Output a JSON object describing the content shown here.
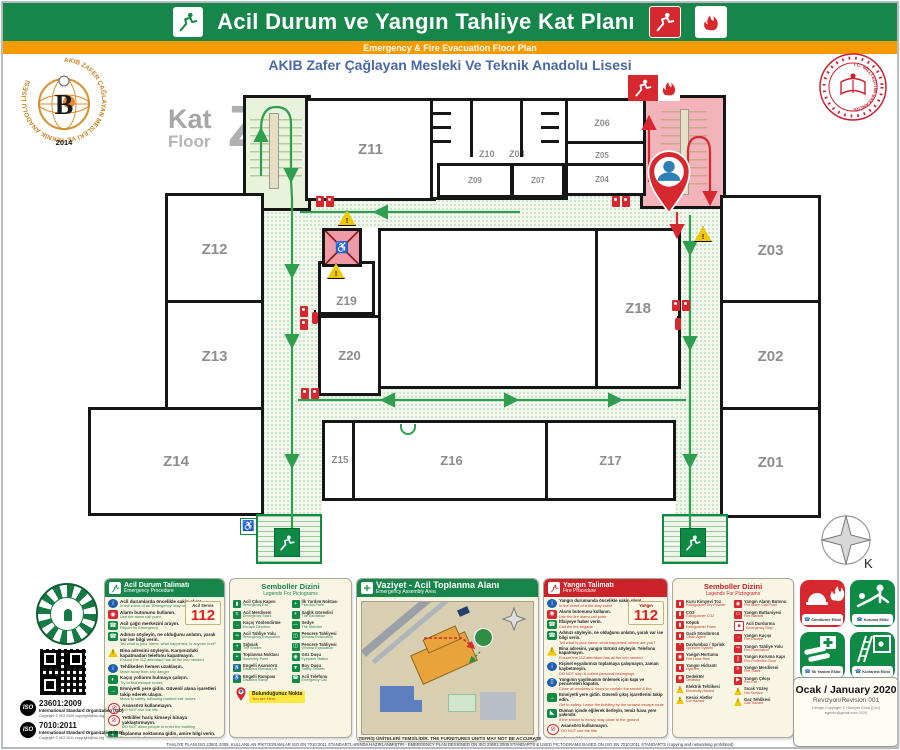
{
  "header": {
    "title": "Acil Durum ve Yangın Tahliye Kat Planı",
    "subtitle": "Emergency & Fire Evacuation Floor Plan",
    "school": "AKIB Zafer Çağlayan Mesleki Ve Teknik Anadolu Lisesi"
  },
  "floor": {
    "kat": "Kat",
    "floor": "Floor",
    "letter": "Z"
  },
  "compass_label": "K",
  "rooms": {
    "z01": "Z01",
    "z02": "Z02",
    "z03": "Z03",
    "z04": "Z04",
    "z05": "Z05",
    "z06": "Z06",
    "z07": "Z07",
    "z08": "Z08",
    "z09": "Z09",
    "z10": "Z10",
    "z11": "Z11",
    "z12": "Z12",
    "z13": "Z13",
    "z14": "Z14",
    "z15": "Z15",
    "z16": "Z16",
    "z17": "Z17",
    "z18": "Z18",
    "z19": "Z19",
    "z20": "Z20"
  },
  "logos": {
    "school_ring": "AKIB ZAFER ÇAĞLAYAN MESLEKİ VE TEKNİK ANADOLU LİSESİ",
    "school_letter": "B",
    "school_year": "2014",
    "ministry_ring": "T.C. MİLLÎ EĞİTİM BAKANLIĞI"
  },
  "emergency_panel": {
    "title_tr": "Acil Durum Talimatı",
    "title_en": "Emergency Procedure",
    "service_label": "Acil Servis",
    "number": "112",
    "items": [
      {
        "type": "t-blue",
        "glyph": "i",
        "tr": "Acil durumlarda öncelikle sakin olun!",
        "en": "In the event of an 'Emergency' stay calm!"
      },
      {
        "type": "t-red",
        "glyph": "◉",
        "tr": "Alarm butonunu kullanın.",
        "en": "Use the alarm call point"
      },
      {
        "type": "t-green",
        "glyph": "☎",
        "tr": "Acil çağrı merkezini arayın.",
        "en": "Report for Emergency"
      },
      {
        "type": "t-green",
        "glyph": "☎",
        "tr": "Adınızı söyleyin, ne olduğunu anlatın, yaralı var ise bilgi verin.",
        "en": "Tell what is your name, what happened, is anyone hurt?"
      },
      {
        "type": "t-yellow",
        "glyph": "!",
        "tr": "Bina adresini söyleyin. Karşınızdaki kapatmadan telefonu kapatmayın.",
        "en": "Ensure the 112 attendant has all the info needed"
      },
      {
        "type": "t-blue",
        "glyph": "i",
        "tr": "Tehlikeden hemen uzaklaşın.",
        "en": "Move away from any danger"
      },
      {
        "type": "t-green",
        "glyph": "◐",
        "tr": "Kaçış yollarını bulmaya çalışın.",
        "en": "Try to find escape routes"
      },
      {
        "type": "t-green",
        "glyph": "→",
        "tr": "Emniyetli yere gidin. Güvenli alana işaretleri takip ederek ulaşın.",
        "en": "Move to safety, following marked exit routes"
      },
      {
        "type": "t-proh",
        "glyph": "⊘",
        "tr": "Asansörü kullanmayın.",
        "en": "DO NOT use the lifts"
      },
      {
        "type": "t-proh",
        "glyph": "⊘",
        "tr": "Yetkililer hariç kimseyi binaya yaklaştırmayın.",
        "en": "DO NOT allow people to enter the building"
      },
      {
        "type": "t-green",
        "glyph": "+",
        "tr": "Toplanma noktasına gidin, amire bilgi verin.",
        "en": "Proceed directly to your assembly point"
      }
    ]
  },
  "fire_panel": {
    "title_tr": "Yangın Talimatı",
    "title_en": "Fire Procedure",
    "service_label": "Yangın",
    "number": "112",
    "items": [
      {
        "type": "t-blue",
        "glyph": "i",
        "tr": "Yangın durumunda öncelikle sakin olun!",
        "en": "In the event of a fire stay calm!"
      },
      {
        "type": "t-red",
        "glyph": "◉",
        "tr": "Alarm butonunu kullanın.",
        "en": "Use the fire alarm call point"
      },
      {
        "type": "t-green",
        "glyph": "☎",
        "tr": "İtfaiyeye haber verin.",
        "en": "Call the fire brigade"
      },
      {
        "type": "t-green",
        "glyph": "☎",
        "tr": "Adınızı söyleyin, ne olduğunu anlatın, yaralı var ise bilgi verin.",
        "en": "Tell what is your name, what happened, where are you?"
      },
      {
        "type": "t-yellow",
        "glyph": "!",
        "tr": "Bina adresini, yangın türünü söyleyin. Telefonu kapatmayın.",
        "en": "Ensure the 112 attendant has all the info needed"
      },
      {
        "type": "t-blue",
        "glyph": "i",
        "tr": "Kişisel eşyalarınızı toplamaya çalışmayın, zaman kaybetmeyin.",
        "en": "DO NOT stop & collect personal belongings"
      },
      {
        "type": "t-blue",
        "glyph": "▯",
        "tr": "Yangının yayılmasını önlemek için kapı ve pencereleri kapatın.",
        "en": "Close all windows & doors to contain the smoke & fire"
      },
      {
        "type": "t-green",
        "glyph": "→",
        "tr": "Emniyetli yere gidin. Güvenli çıkış işaretlerini takip edin.",
        "en": "Get to safety. Leave the building by the nearest escape route"
      },
      {
        "type": "t-green",
        "glyph": "◣",
        "tr": "Duman içinde eğilerek ilerleyin, temiz hava yere yakındır.",
        "en": "If the smoke is heavy, stay close to the ground"
      },
      {
        "type": "t-proh",
        "glyph": "⊘",
        "tr": "Asansörü kullanmayın.",
        "en": "DO NOT use the lifts"
      },
      {
        "type": "t-proh",
        "glyph": "⊘",
        "tr": "Kimseyi binaya yaklaştırmayın.",
        "en": "DO NOT allow people to enter the building"
      },
      {
        "type": "t-green",
        "glyph": "+",
        "tr": "Toplanma noktasına gidin, amire bilgi verin.",
        "en": "Proceed directly to your assembly point"
      }
    ]
  },
  "symbols_green": {
    "title_tr": "Semboller Dizini",
    "title_en": "Legends For Pictograms",
    "left": [
      {
        "g": "▮",
        "c": "sg",
        "tr": "Acil Çıkış Kapısı",
        "en": "Emergency Exit"
      },
      {
        "g": "≡",
        "c": "sg",
        "tr": "Acil Merdiveni",
        "en": "Emergency Stairs"
      },
      {
        "g": "→",
        "c": "sg",
        "tr": "Kaçış Yönlendirme",
        "en": "Escape Direction"
      },
      {
        "g": "⇒",
        "c": "sg",
        "tr": "Acil Tahliye Yolu",
        "en": "Emergency Evacuation"
      },
      {
        "g": "◖",
        "c": "sg",
        "tr": "Sığınak",
        "en": "The Shelter"
      },
      {
        "g": "+",
        "c": "sg",
        "tr": "Toplanma Noktası",
        "en": "Assembly Point"
      },
      {
        "g": "♿",
        "c": "sg",
        "tr": "Engelli Asansörü",
        "en": "Disabled Elevator Lift"
      },
      {
        "g": "♿",
        "c": "sg",
        "tr": "Engelli Rampası",
        "en": "Disabled Ramp"
      }
    ],
    "right": [
      {
        "g": "+",
        "c": "sg",
        "tr": "İlk Yardım Noktası",
        "en": "First Aid Point"
      },
      {
        "g": "+",
        "c": "sg",
        "tr": "Sağlık Görevlisi",
        "en": "The Sanitarian"
      },
      {
        "g": "—",
        "c": "sg",
        "tr": "Sedye",
        "en": "The Strecher"
      },
      {
        "g": "◫",
        "c": "sg",
        "tr": "Pencere Tahliyesi",
        "en": "Window Evacuation"
      },
      {
        "g": "◫",
        "c": "sg",
        "tr": "Pencere Tahliyesi",
        "en": "Window Evacuation"
      },
      {
        "g": "◉",
        "c": "sg",
        "tr": "Göz Duşu",
        "en": "Eyewash Station"
      },
      {
        "g": "▼",
        "c": "sg",
        "tr": "Boy Duşu",
        "en": "Safety Shower"
      },
      {
        "g": "☎",
        "c": "sg",
        "tr": "Acil Telefonu",
        "en": "Emergency Call"
      }
    ],
    "here": {
      "tr": "Bulunduğunuz Nokta",
      "en": "You are Here"
    }
  },
  "symbols_red": {
    "title_tr": "Semboller Dizini",
    "title_en": "Legends For Pictograms",
    "left": [
      {
        "g": "▮",
        "c": "sr",
        "tr": "Kuru Kimyevi Toz",
        "en": "Extinguisher Dry Powder"
      },
      {
        "g": "▮",
        "c": "sr",
        "tr": "CO2",
        "en": "Extinguisher CO2"
      },
      {
        "g": "▮",
        "c": "sr",
        "tr": "Köpük",
        "en": "Extinguisher Foam"
      },
      {
        "g": "▮",
        "c": "sr",
        "tr": "Gazlı Söndürücü",
        "en": "Clean Agent"
      },
      {
        "g": "*",
        "c": "sr",
        "tr": "Davlumbaz / Sprink",
        "en": "Sprinkler System"
      },
      {
        "g": "◉",
        "c": "sr",
        "tr": "Yangın Hortumu",
        "en": "Fire Hose Reel"
      },
      {
        "g": "▮",
        "c": "sr",
        "tr": "Yangın Hidrantı",
        "en": "Hydrant"
      },
      {
        "g": "◉",
        "c": "sr",
        "tr": "Dedektör",
        "en": "Dedector"
      },
      {
        "g": "!",
        "c": "sy",
        "tr": "Elektrik Tehlikesi",
        "en": "Electricity Hazard"
      },
      {
        "g": "!",
        "c": "sy",
        "tr": "Kesici Aletler",
        "en": "Cut Hazard"
      }
    ],
    "right": [
      {
        "g": "◉",
        "c": "sr",
        "tr": "Yangın Alarm Butonu",
        "en": "Fire Alarm Call Point"
      },
      {
        "g": "▭",
        "c": "sr",
        "tr": "Yangın Battaniyesi",
        "en": "Fire Blanket"
      },
      {
        "g": "■",
        "c": "sw",
        "tr": "Acil Durdurma",
        "en": "Emergency Stop"
      },
      {
        "g": "→",
        "c": "sr",
        "tr": "Yangın Kaçışı",
        "en": "Fire Escape"
      },
      {
        "g": "⇒",
        "c": "sr",
        "tr": "Yangın Tahliye Yolu",
        "en": "Fire Evacuation"
      },
      {
        "g": "▯",
        "c": "sr",
        "tr": "Yangın Koruma Kapı",
        "en": "Fire Protection Door"
      },
      {
        "g": "≡",
        "c": "sr",
        "tr": "Yangın Merdiveni",
        "en": "Fire Stairs"
      },
      {
        "g": "▶",
        "c": "sr",
        "tr": "Yangın Çıkışı",
        "en": "Fire Exit"
      },
      {
        "g": "!",
        "c": "sy",
        "tr": "Sıcak Yüzey",
        "en": "Hot Surface"
      },
      {
        "g": "!",
        "c": "sy",
        "tr": "Gaz Tehlikesi",
        "en": "Gaz Hazard"
      }
    ]
  },
  "assembly_panel": {
    "title_tr": "Vaziyet - Acil Toplanma Alanı",
    "title_en": "Emergency Assembly Area"
  },
  "teams": [
    {
      "label": "Söndürme Ekibi",
      "color": "red"
    },
    {
      "label": "Koruma Ekibi",
      "color": "green"
    },
    {
      "label": "İlk Yardım Ekibi",
      "color": "green"
    },
    {
      "label": "Kurtarma Ekibi",
      "color": "green"
    }
  ],
  "revision": {
    "date": "Ocak / January 2020",
    "rev": "Revizyon/Revision  001",
    "copy1": "Design Copyright © Hüseyin Güriş (Çizi)",
    "copy2": "egrinfo@gmail.com 2020"
  },
  "iso": [
    {
      "code": "23601:2009",
      "org1": "International Standard",
      "org2": "Organization (ISO)",
      "copy": "Copyright © ISO 2009 copyright@iso.org"
    },
    {
      "code": "7010:2011",
      "org1": "International Standard",
      "org2": "Organization (ISO)",
      "copy": "Copyright © ISO 2011 copyright@iso.org"
    }
  ],
  "footer": {
    "line1": "TEFRİŞ ÜNİTELERİ TEMSİLİDİR. THE FURNITURES UNITS MAY NOT BE ACCURATE",
    "line2": "TAHLİYE PLANI ISO 23601:2009, KULLANILAN PİKTOGRAMLAR ISO EN 7010:2011 STANDARTLARINDA HAZIRLANMIŞTIR - EMERGENCY PLAN DESIGNED ON ISO 23601:2009 STANDARTS & USED PICTOGRAMS BASED ON ISO EN 7010:2011 STANDARTS (copying and networking prohibited)"
  },
  "icons": [
    "exit-man-icon",
    "fire-exit-icon",
    "flames-icon",
    "extinguisher-icon",
    "fire-hose-icon",
    "alarm-button-icon",
    "warning-triangle-icon",
    "wheelchair-icon",
    "no-elevator-icon",
    "you-are-here-pin",
    "compass-rose",
    "assembly-point-icon",
    "phone-icon",
    "qr-code",
    "iso-logo",
    "school-logo",
    "ministry-seal"
  ]
}
